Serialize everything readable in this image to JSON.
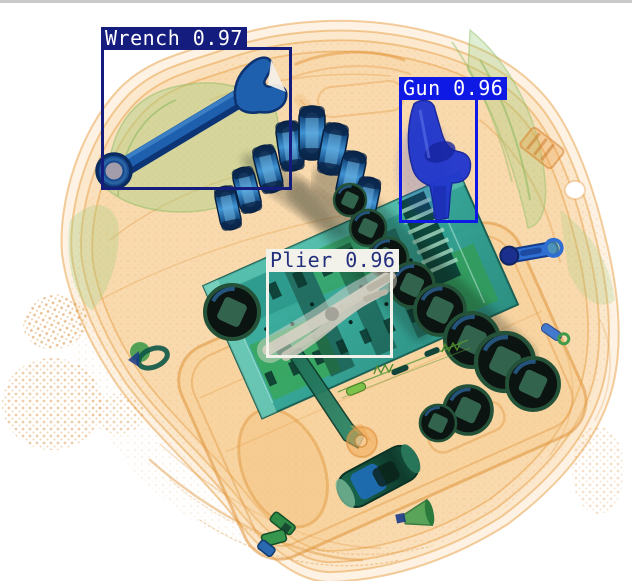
{
  "detections": [
    {
      "label": "Wrench",
      "score": 0.97,
      "display": "Wrench 0.97",
      "box": {
        "x": 101,
        "y": 47,
        "w": 191,
        "h": 143
      },
      "box_color": "#141c7e",
      "label_bg": "#141c7e",
      "label_color": "#ffffff"
    },
    {
      "label": "Gun",
      "score": 0.96,
      "display": "Gun 0.96",
      "box": {
        "x": 399,
        "y": 97,
        "w": 79,
        "h": 126
      },
      "box_color": "#0e19e6",
      "label_bg": "#0e19e6",
      "label_color": "#ffffff"
    },
    {
      "label": "Plier",
      "score": 0.96,
      "display": "Plier 0.96",
      "box": {
        "x": 266,
        "y": 269,
        "w": 127,
        "h": 89
      },
      "box_color": "#f2f1ea",
      "label_bg": "#f2f1ea",
      "label_color": "#232f7d"
    }
  ],
  "scene": {
    "background": "#ffffff",
    "top_edge_line": "#c9c9c9",
    "palette": {
      "bag_orange": "#e89e42",
      "organic_green": "#9cc878",
      "board_teal": "#2aa296",
      "metal_dark": "#0c1411",
      "socket_blue": "#2e7fc4",
      "wrench_blue": "#1e5fae",
      "gun_blue": "#2136cc",
      "plier_gray": "#d6d2c4"
    }
  }
}
